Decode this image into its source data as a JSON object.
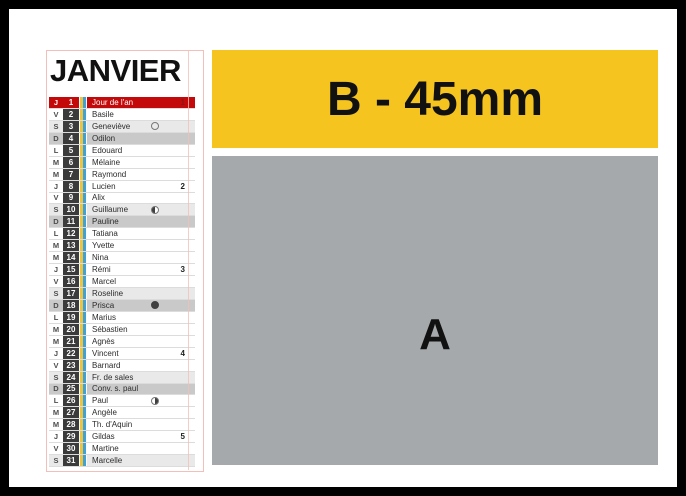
{
  "calendar": {
    "title": "JANVIER",
    "days": [
      {
        "letter": "J",
        "num": "1",
        "name": "Jour de l'an",
        "type": "holiday",
        "week": "1"
      },
      {
        "letter": "V",
        "num": "2",
        "name": "Basile",
        "type": "weekday"
      },
      {
        "letter": "S",
        "num": "3",
        "name": "Geneviève",
        "type": "saturday",
        "moon": "outline"
      },
      {
        "letter": "D",
        "num": "4",
        "name": "Odilon",
        "type": "sunday"
      },
      {
        "letter": "L",
        "num": "5",
        "name": "Edouard",
        "type": "weekday"
      },
      {
        "letter": "M",
        "num": "6",
        "name": "Mélaine",
        "type": "weekday"
      },
      {
        "letter": "M",
        "num": "7",
        "name": "Raymond",
        "type": "weekday"
      },
      {
        "letter": "J",
        "num": "8",
        "name": "Lucien",
        "type": "weekday",
        "week": "2"
      },
      {
        "letter": "V",
        "num": "9",
        "name": "Alix",
        "type": "weekday"
      },
      {
        "letter": "S",
        "num": "10",
        "name": "Guillaume",
        "type": "saturday",
        "moon": "half-left"
      },
      {
        "letter": "D",
        "num": "11",
        "name": "Pauline",
        "type": "sunday"
      },
      {
        "letter": "L",
        "num": "12",
        "name": "Tatiana",
        "type": "weekday"
      },
      {
        "letter": "M",
        "num": "13",
        "name": "Yvette",
        "type": "weekday"
      },
      {
        "letter": "M",
        "num": "14",
        "name": "Nina",
        "type": "weekday"
      },
      {
        "letter": "J",
        "num": "15",
        "name": "Rémi",
        "type": "weekday",
        "week": "3"
      },
      {
        "letter": "V",
        "num": "16",
        "name": "Marcel",
        "type": "weekday"
      },
      {
        "letter": "S",
        "num": "17",
        "name": "Roseline",
        "type": "saturday"
      },
      {
        "letter": "D",
        "num": "18",
        "name": "Prisca",
        "type": "sunday",
        "moon": "filled"
      },
      {
        "letter": "L",
        "num": "19",
        "name": "Marius",
        "type": "weekday"
      },
      {
        "letter": "M",
        "num": "20",
        "name": "Sébastien",
        "type": "weekday"
      },
      {
        "letter": "M",
        "num": "21",
        "name": "Agnès",
        "type": "weekday"
      },
      {
        "letter": "J",
        "num": "22",
        "name": "Vincent",
        "type": "weekday",
        "week": "4"
      },
      {
        "letter": "V",
        "num": "23",
        "name": "Barnard",
        "type": "weekday"
      },
      {
        "letter": "S",
        "num": "24",
        "name": "Fr. de sales",
        "type": "saturday"
      },
      {
        "letter": "D",
        "num": "25",
        "name": "Conv. s. paul",
        "type": "sunday"
      },
      {
        "letter": "L",
        "num": "26",
        "name": "Paul",
        "type": "weekday",
        "moon": "half-right"
      },
      {
        "letter": "M",
        "num": "27",
        "name": "Angèle",
        "type": "weekday"
      },
      {
        "letter": "M",
        "num": "28",
        "name": "Th. d'Aquin",
        "type": "weekday"
      },
      {
        "letter": "J",
        "num": "29",
        "name": "Gildas",
        "type": "weekday",
        "week": "5"
      },
      {
        "letter": "V",
        "num": "30",
        "name": "Martine",
        "type": "weekday"
      },
      {
        "letter": "S",
        "num": "31",
        "name": "Marcelle",
        "type": "saturday"
      }
    ]
  },
  "blocks": {
    "b_label": "B - 45mm",
    "a_label": "A"
  },
  "colors": {
    "holiday_red": "#C30909",
    "date_cell": "#3B3B3B",
    "saturday_bg": "#E9E9E9",
    "sunday_bg": "#C9C9C9",
    "stripe_yellow": "#EEC33E",
    "stripe_blue": "#3EA2D8",
    "block_b_yellow": "#F5C41F",
    "block_a_gray": "#A6A9AB",
    "guide_pink": "#F2C0B8"
  }
}
